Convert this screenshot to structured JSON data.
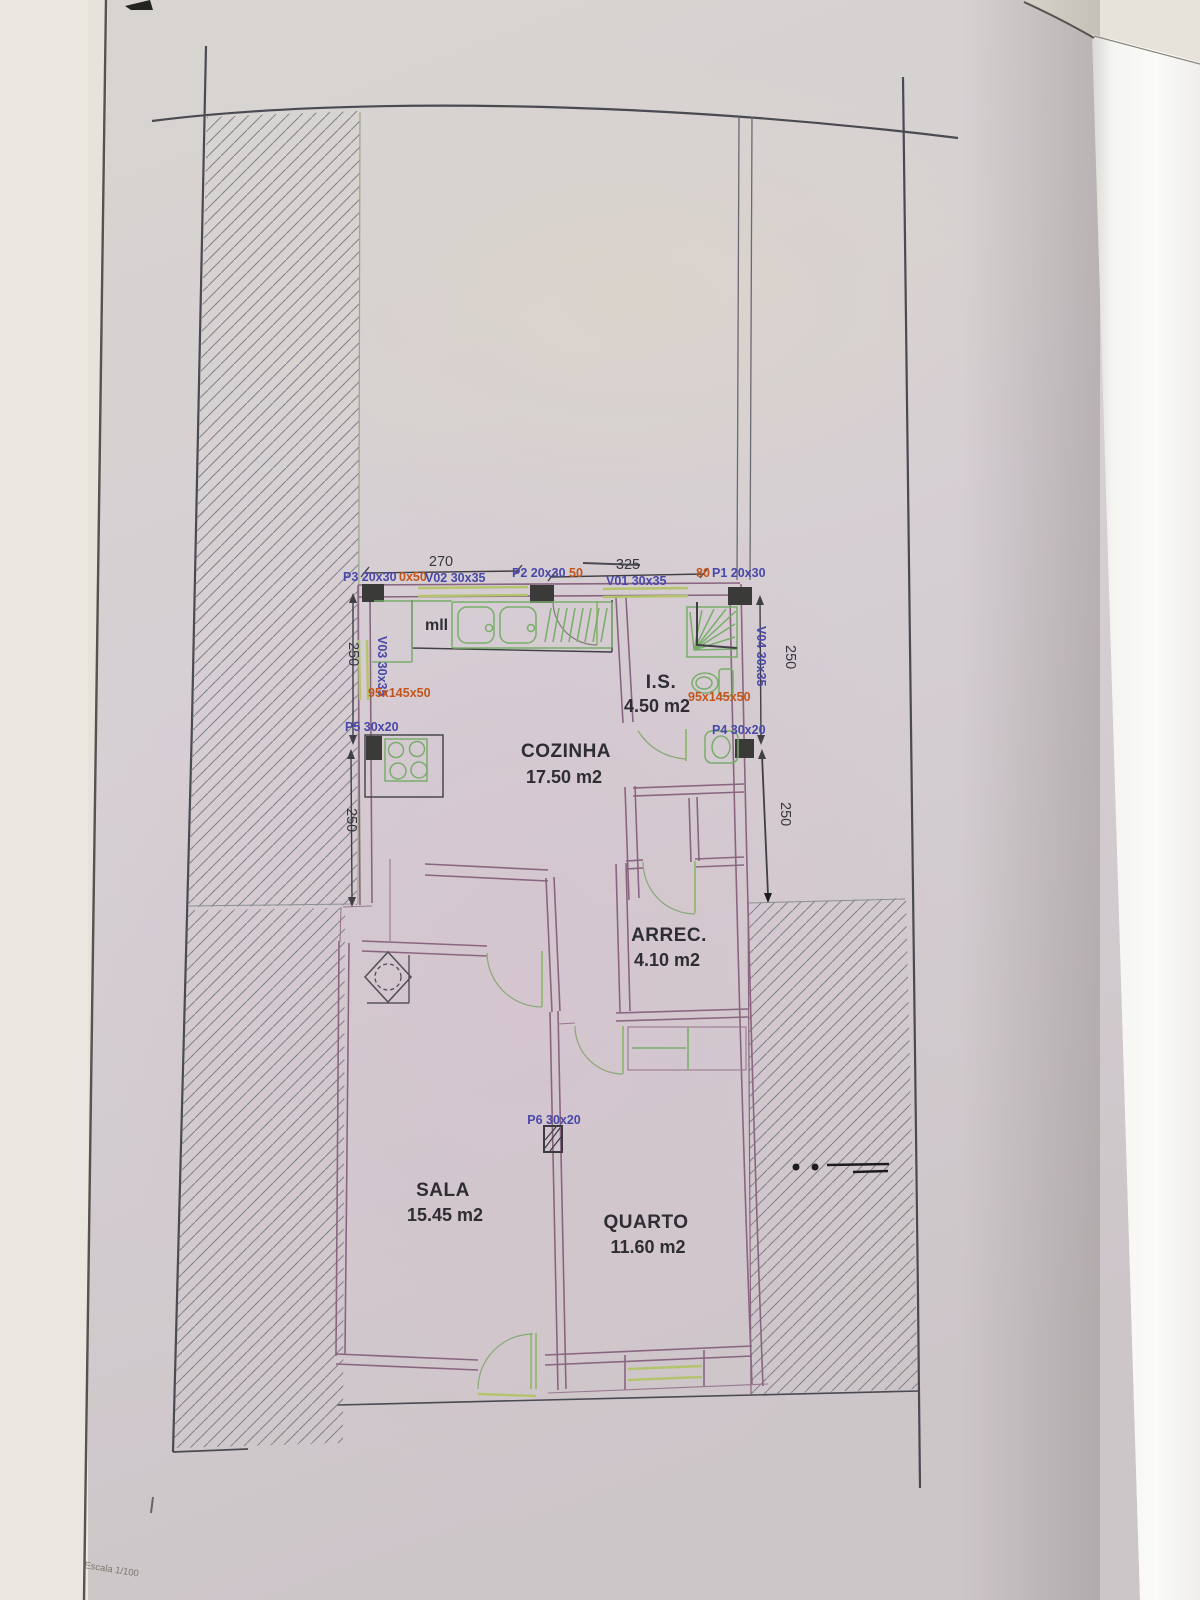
{
  "drawing": {
    "scale_label": "Escala 1/100",
    "rooms": [
      {
        "name": "COZINHA",
        "area": "17.50 m2"
      },
      {
        "name": "I.S.",
        "area": "4.50 m2"
      },
      {
        "name": "ARREC.",
        "area": "4.10 m2"
      },
      {
        "name": "SALA",
        "area": "15.45 m2"
      },
      {
        "name": "QUARTO",
        "area": "11.60 m2"
      }
    ],
    "door_labels": [
      {
        "id": "p3",
        "text": "P3 20x30",
        "extra": "0x50"
      },
      {
        "id": "p2",
        "text": "P2 20x30",
        "extra": "50"
      },
      {
        "id": "p1",
        "text": "P1 20x30",
        "extra": "80"
      },
      {
        "id": "p4",
        "text": "P4 30x20"
      },
      {
        "id": "p5",
        "text": "P5 30x20"
      },
      {
        "id": "p6",
        "text": "P6 30x20"
      }
    ],
    "window_labels": [
      {
        "id": "v01",
        "text": "V01 30x35"
      },
      {
        "id": "v02",
        "text": "V02 30x35"
      },
      {
        "id": "v03",
        "text": "V03 30x35"
      },
      {
        "id": "v04",
        "text": "V04 30x35"
      }
    ],
    "sill_labels": {
      "left": "95x145x50",
      "right": "95x145x50"
    },
    "dimensions": {
      "top_left": "270",
      "top_right": "325",
      "left_upper": "250",
      "left_lower": "250",
      "right_upper": "250",
      "right_lower": "250"
    },
    "notes": {
      "kitchen_appliance": "mll"
    },
    "colors": {
      "wall_purple": "#8a6580",
      "fixture_green": "#79ad6b",
      "window_green": "#b4c46c",
      "label_blue": "#4848a8",
      "label_orange": "#c2551c",
      "ink": "#4a4a52"
    }
  }
}
